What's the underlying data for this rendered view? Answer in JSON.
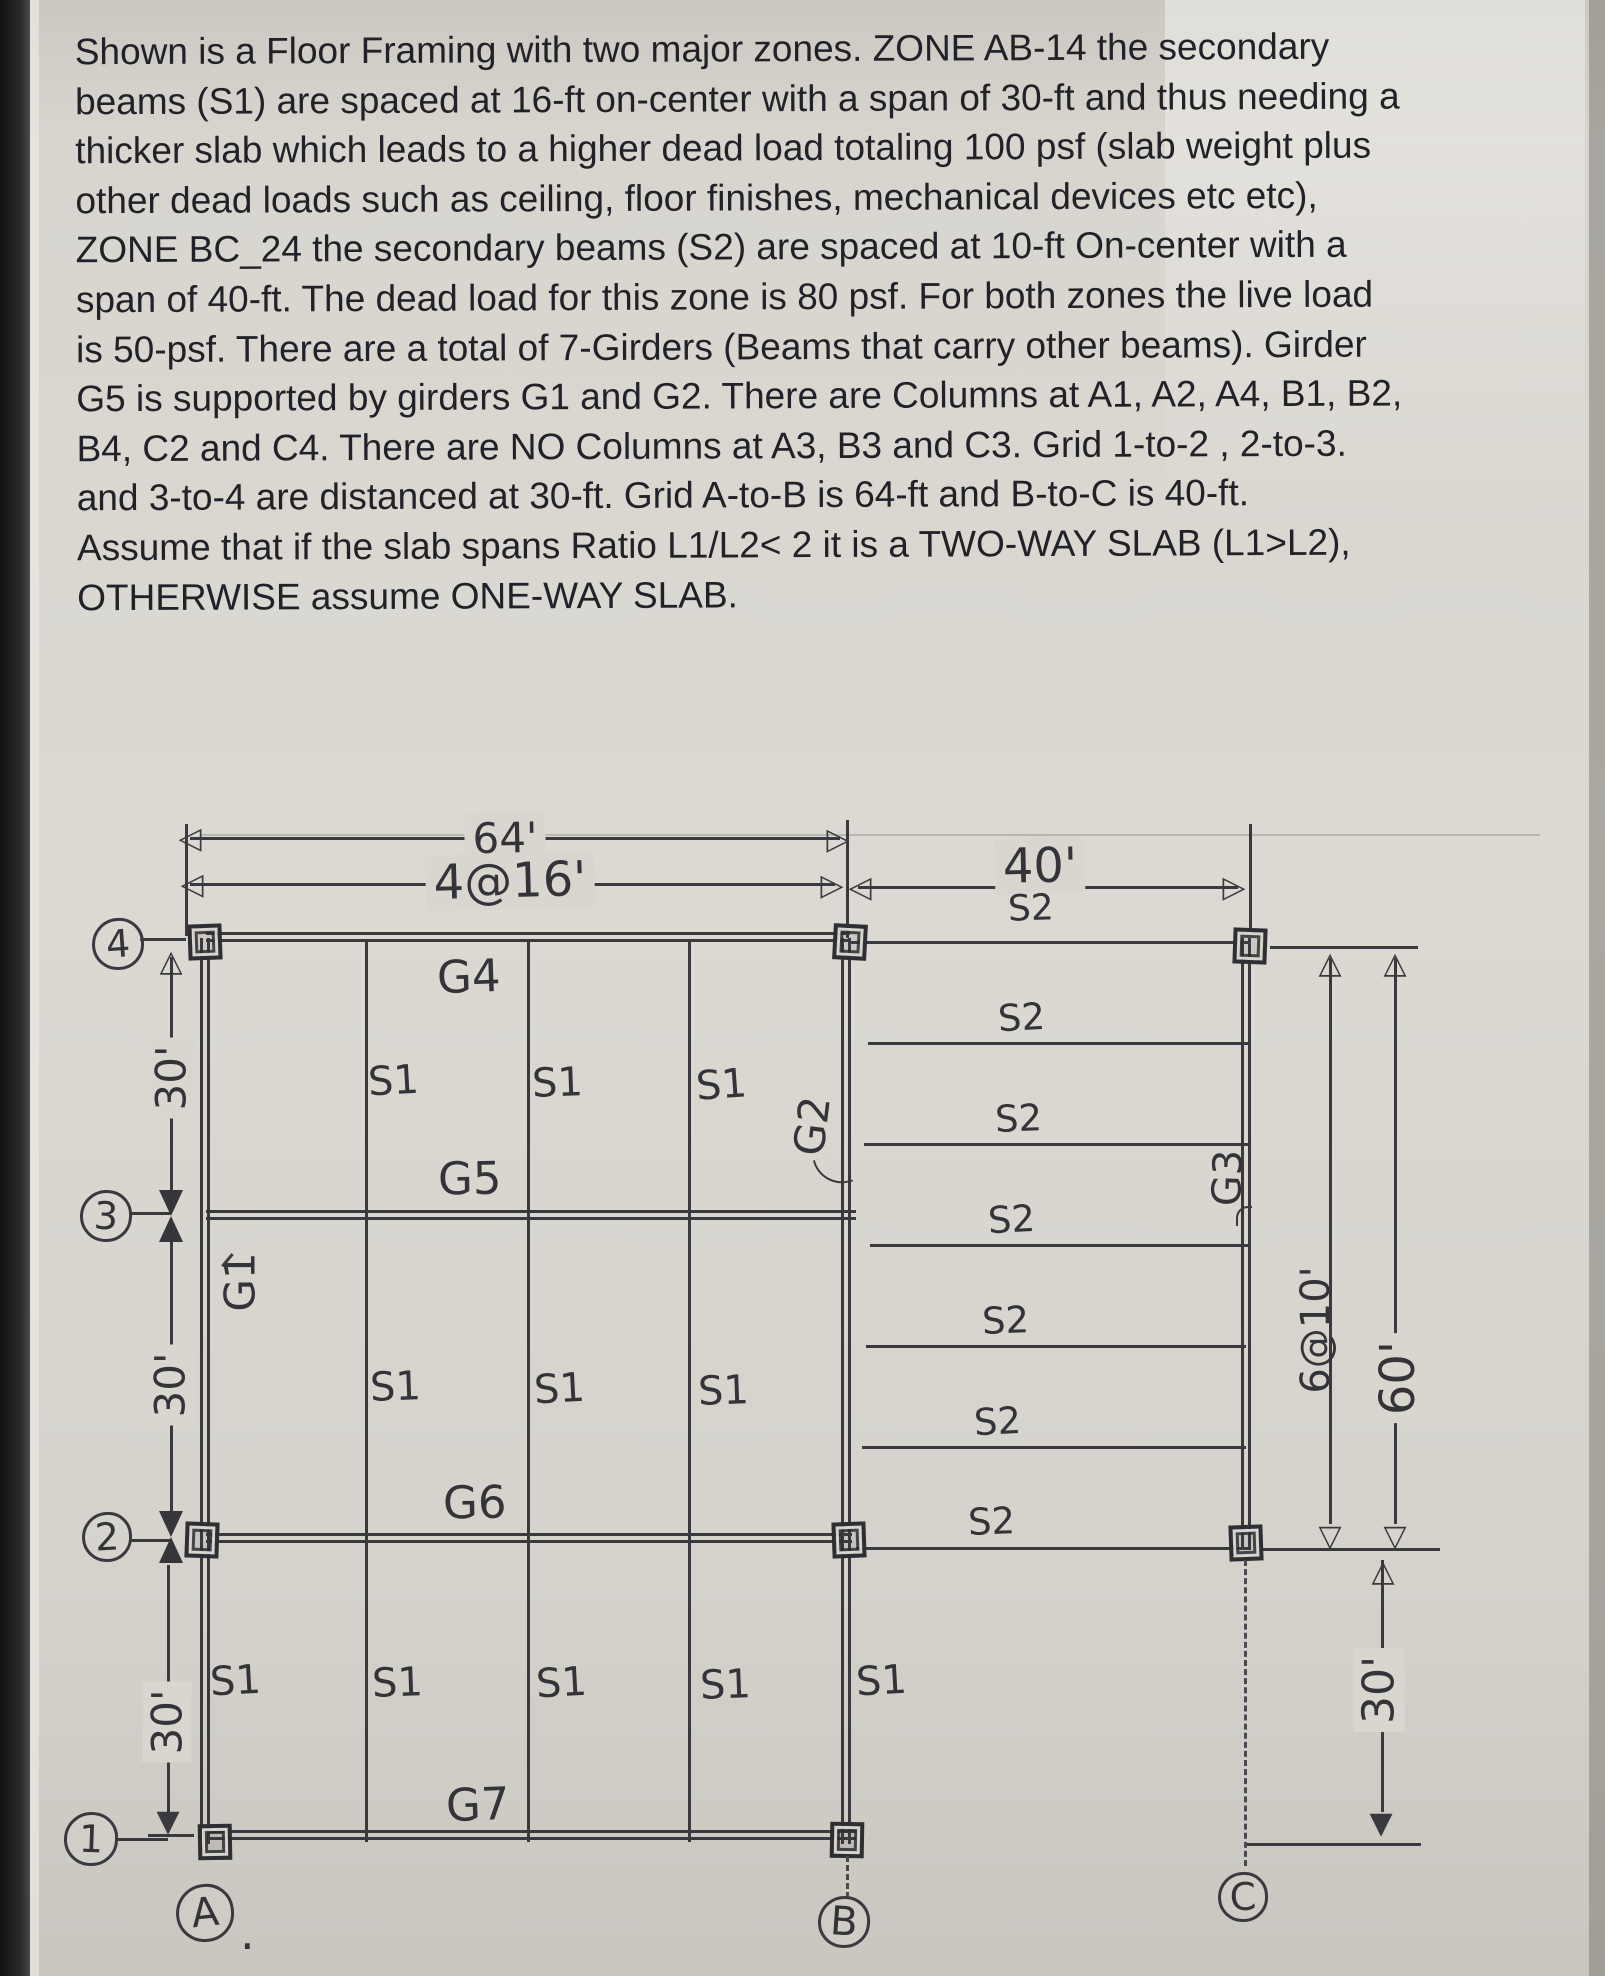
{
  "document": {
    "paragraph_lines": [
      "Shown is a Floor Framing with two major zones. ZONE AB-14 the secondary",
      "beams (S1) are spaced at 16-ft on-center with a span of 30-ft and thus needing a",
      "thicker slab which leads to a higher dead load totaling  100 psf (slab weight  plus",
      "other dead loads such as ceiling, floor finishes, mechanical  devices etc etc),",
      "ZONE BC_24 the secondary beams (S2) are spaced at 10-ft On-center with a",
      "span of 40-ft. The dead load for this zone is 80 psf.  For both zones the live load",
      "is 50-psf. There are a total of 7-Girders (Beams that carry other beams). Girder",
      "G5 is supported by girders G1 and G2. There are Columns at A1, A2, A4, B1, B2,",
      "B4, C2 and C4.  There are NO Columns at A3, B3 and C3.  Grid 1-to-2 , 2-to-3.",
      "and  3-to-4  are distanced at 30-ft. Grid A-to-B is 64-ft and B-to-C is 40-ft.",
      "Assume that if the slab spans Ratio L1/L2< 2 it is a TWO-WAY SLAB (L1>L2),",
      "OTHERWISE assume ONE-WAY SLAB."
    ]
  },
  "diagram": {
    "dimensions": {
      "ab_total": "64'",
      "ab_spacing": "4@16'",
      "bc_total": "40'",
      "left_30_top": "30'",
      "left_30_mid": "30'",
      "left_30_bot": "30'",
      "bc_spacing": "6@10'",
      "bc_depth": "60'",
      "right_30": "30'"
    },
    "labels": {
      "s1": "S1",
      "s2": "S2",
      "g1": "G1",
      "g2": "G2",
      "g3": "G3",
      "g4": "G4",
      "g5": "G5",
      "g6": "G6",
      "g7": "G7"
    },
    "grid_lines": {
      "row4": "4",
      "row3": "3",
      "row2": "2",
      "row1": "1",
      "col_a": "A",
      "col_a_period": ".",
      "col_b": "B",
      "col_c": "C"
    }
  },
  "icons": {
    "tri_left": "◁",
    "tri_right": "▷",
    "tri_up": "△",
    "tri_down": "▽",
    "tri_down_filled": "▼"
  },
  "colors": {
    "paper": "#d7d4ce",
    "ink": "#3a3a3e",
    "text": "#212127",
    "edge": "#141414"
  }
}
